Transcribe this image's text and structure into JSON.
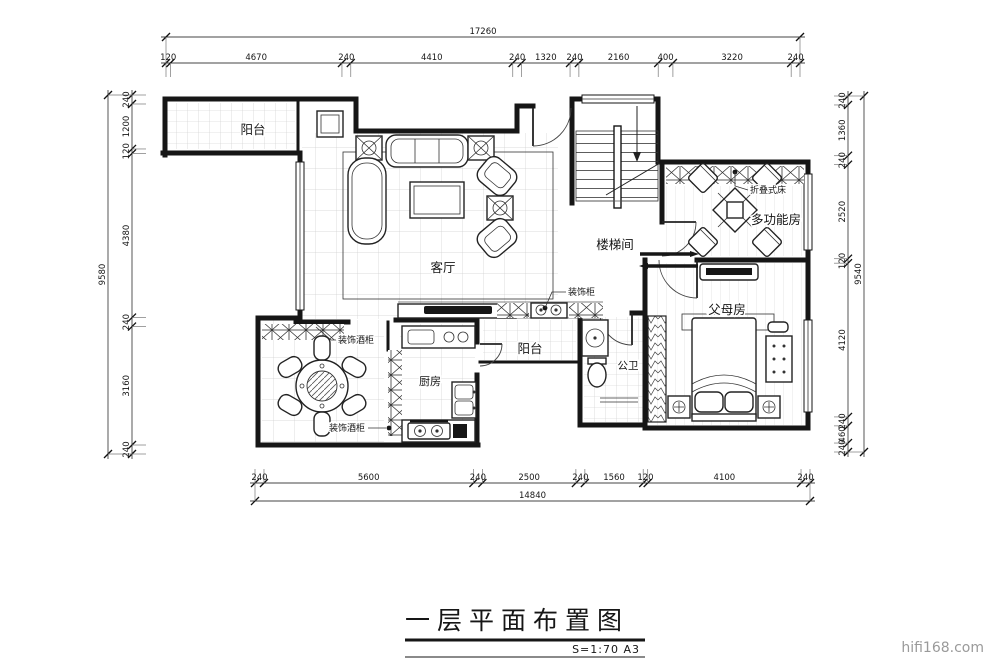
{
  "sheet": {
    "title": "一层平面布置图",
    "scale_note": "S=1:70 A3",
    "watermark": "hifi168.com"
  },
  "rooms": {
    "balcony_top": "阳台",
    "living": "客厅",
    "stairwell": "楼梯间",
    "multi_function": "多功能房",
    "parents": "父母房",
    "bath": "公卫",
    "kitchen": "厨房",
    "balcony_mid": "阳台"
  },
  "annotations": {
    "folding_bed": "折叠式床",
    "decorative_cabinet": "装饰柜",
    "wine_cabinet_upper": "装饰酒柜",
    "wine_cabinet_lower": "装饰酒柜"
  },
  "dimensions": {
    "top": {
      "total": "17260",
      "segments": [
        120,
        4670,
        240,
        4410,
        240,
        1320,
        240,
        2160,
        400,
        3220,
        240
      ]
    },
    "bottom": {
      "total": "14840",
      "segments": [
        240,
        5600,
        240,
        2500,
        240,
        1560,
        120,
        4100,
        240
      ]
    },
    "left": {
      "total": "9580",
      "segments": [
        240,
        1200,
        120,
        4380,
        240,
        3160,
        240
      ]
    },
    "right": {
      "total": "9540",
      "segments": [
        240,
        1360,
        240,
        2520,
        120,
        4120,
        240,
        460,
        240
      ]
    }
  }
}
